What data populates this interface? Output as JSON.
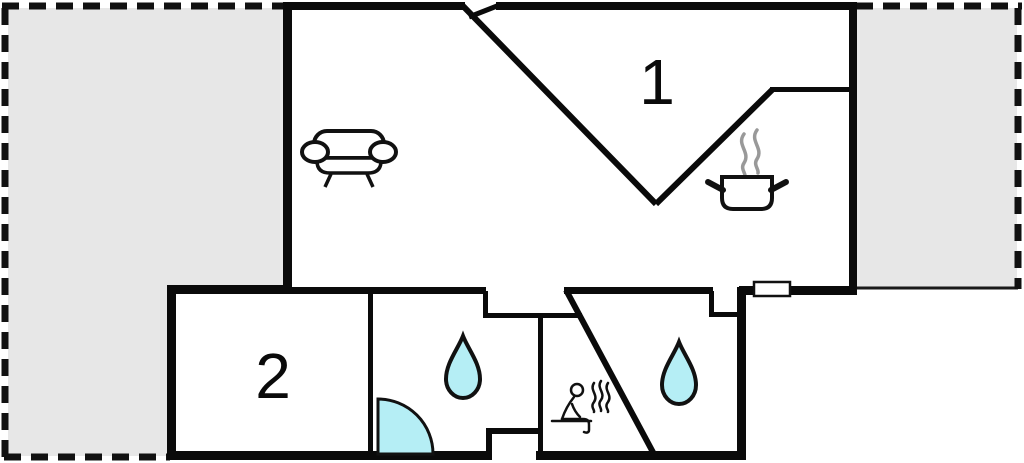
{
  "floorplan": {
    "rooms": [
      {
        "label": "1"
      },
      {
        "label": "2"
      }
    ],
    "icons": [
      "sofa-icon",
      "cooking-pot-icon",
      "steam-icon",
      "water-drop-icon",
      "water-drop-icon",
      "shower-door-icon",
      "sauna-person-icon",
      "window-symbol"
    ],
    "colors": {
      "wall": "#0a0a0a",
      "plot_boundary": "#111111",
      "terrace": "#e7e7e7",
      "water_fill": "#b5eef5",
      "steam": "#999999",
      "window_fill": "#ffffff",
      "background": "#ffffff"
    }
  }
}
